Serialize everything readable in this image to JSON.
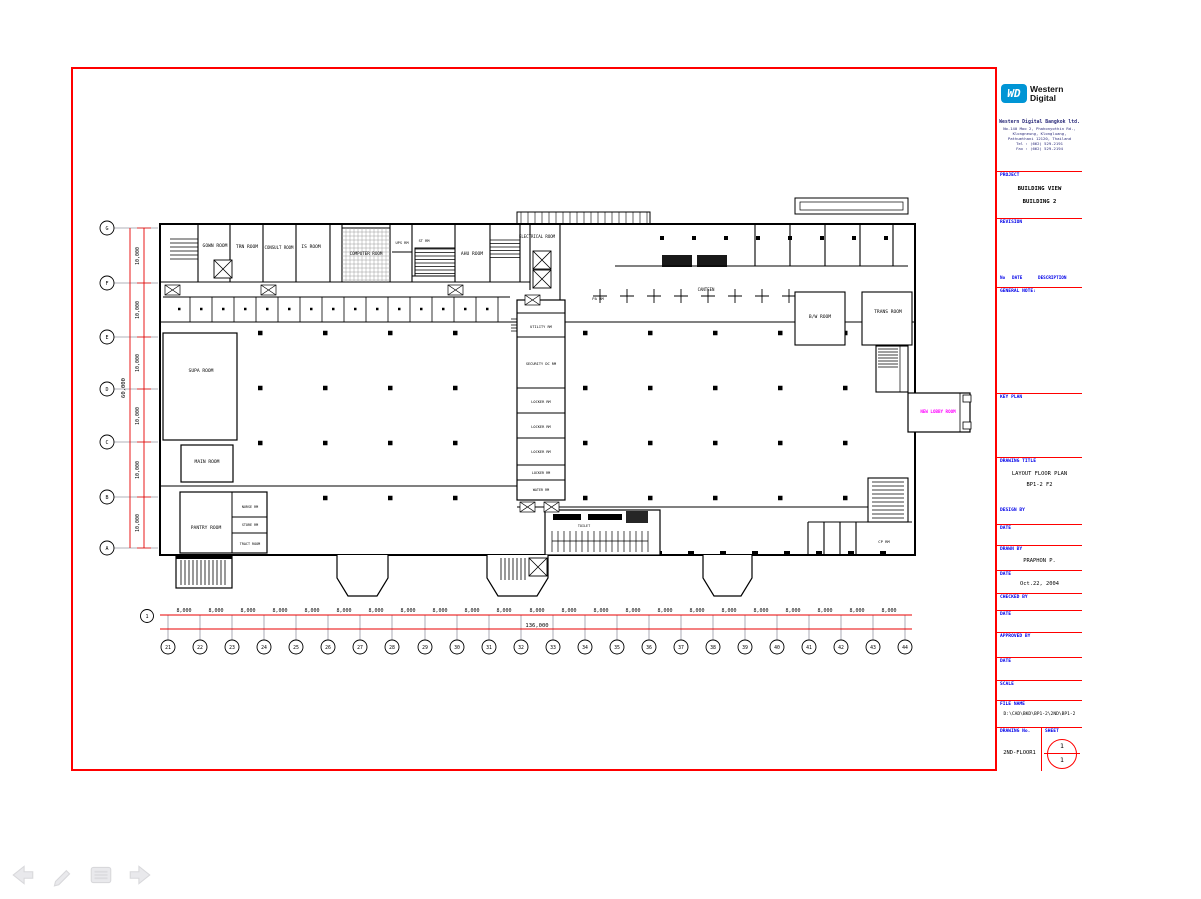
{
  "colors": {
    "sheet_border": "#ff0000",
    "dim_line": "#e80000",
    "label_blue": "#0000e8",
    "room_magenta": "#ff00ff",
    "wd_blue": "#0095d5"
  },
  "viewer": {
    "nav": {
      "back": "back-arrow",
      "pen": "pen-tool",
      "menu": "slide-menu",
      "forward": "forward-arrow"
    }
  },
  "tb": {
    "brand": {
      "abbr": "WD",
      "line1": "Western",
      "line2": "Digital"
    },
    "company": {
      "name": "Western Digital Bangkok ltd.",
      "address": [
        "No.140 Moo 2, Phahonyothin Rd.,",
        "Klongneung, Klongluang,",
        "Pathumthani 12120, Thailand",
        "Tel : (662) 529-2191",
        "Fax : (662) 529-2194"
      ]
    },
    "project": {
      "label": "PROJECT",
      "line1": "BUILDING VIEW",
      "line2": "BUILDING 2"
    },
    "revision": {
      "label": "REVISION",
      "no": "No",
      "date": "DATE",
      "desc": "DESCRIPTION"
    },
    "general_note": "GENERAL NOTE:",
    "key_plan": "KEY PLAN",
    "drawing_title": {
      "label": "DRAWING TITLE",
      "line1": "LAYOUT FLOOR PLAN",
      "line2": "BP1-2 F2"
    },
    "design_by": "DESIGN BY",
    "date_label": "DATE",
    "drawn_by_label": "DRAWN BY",
    "drawn_by": "PRAPHON P.",
    "drawn_date": "Oct.22, 2004",
    "checked_by": "CHECKED BY",
    "approved_by": "APPROVED BY",
    "scale_label": "SCALE",
    "file_label": "FILE NAME",
    "file_name": "D:\\CAD\\BKD\\BP1-2\\2ND\\BP1-2",
    "dwg_no_label": "DRAWING No.",
    "dwg_no": "2ND-FLOOR1",
    "sheet_label": "SHEET",
    "sheet_top": "1",
    "sheet_bottom": "1"
  },
  "plan": {
    "rooms": {
      "gown": "GOWN ROOM",
      "trn": "TRN ROOM",
      "consult": "CONSULT ROOM",
      "ie": "IS ROOM",
      "computer": "COMPUTER ROOM",
      "ups": "UPS RM",
      "st": "ST RM",
      "ahu": "AHU ROOM",
      "electrical": "ELECTRICAL ROOM",
      "pa": "PA RM",
      "canteen": "CANTEEN",
      "bw": "B/W ROOM",
      "trans": "TRANS ROOM",
      "supa": "SUPA ROOM",
      "main": "MAIN ROOM",
      "pantry": "PANTRY ROOM",
      "nurse": "NURSE RM",
      "store": "STORE RM",
      "tract": "TRACT ROOM",
      "utility": "UTILITY RM",
      "security": "SECURITY DC RM",
      "locker1": "LOCKER RM",
      "locker2": "LOCKER RM",
      "locker3": "LOCKER RM",
      "locker4": "LOCKER RM",
      "water": "WATER RM",
      "toilet": "TOILET",
      "lobby": "NEW LOBBY ROOM",
      "cp": "CP RM"
    },
    "grid": {
      "ref": "1",
      "col_dim": "8,000",
      "col_total": "136,000",
      "cols": [
        "21",
        "22",
        "23",
        "24",
        "25",
        "26",
        "27",
        "28",
        "29",
        "30",
        "31",
        "32",
        "33",
        "34",
        "35",
        "36",
        "37",
        "38",
        "39",
        "40",
        "41",
        "42",
        "43",
        "44"
      ],
      "rows": [
        "G",
        "F",
        "E",
        "D",
        "C",
        "B",
        "A"
      ],
      "row_dim": "10,000",
      "row_total": "60,000"
    }
  }
}
